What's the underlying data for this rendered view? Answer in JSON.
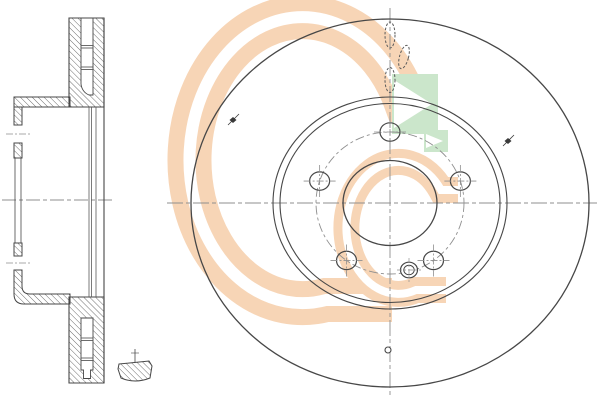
{
  "meta": {
    "description": "Engineering drawing of a ventilated brake disc: left cross-section view, right front view, small edge-detail section, manufacturer G-logo watermark",
    "background": "#ffffff"
  },
  "colors": {
    "line": "#474747",
    "centerline": "#8f8f8f",
    "hidden": "#5a5a5a",
    "hatch": "#606060",
    "watermark_peach": "#f7d5b6",
    "watermark_green": "#cbe6cb",
    "marker": "#3a3a3a"
  },
  "views": {
    "section_view": {
      "name": "cross-section-of-vented-disc",
      "vane_divider_pairs_top": [
        [
          45.5,
          48
        ],
        [
          67,
          69.5
        ]
      ],
      "vane_divider_pairs_bottom": [
        [
          338,
          340.5
        ],
        [
          358,
          360.5
        ]
      ],
      "bolt_hole_tick_y": [
        134,
        263
      ],
      "axis_y": 200
    },
    "front_view": {
      "name": "front-view-of-disc",
      "center": {
        "x": 390,
        "y": 203
      },
      "centerline_v": {
        "x": 390,
        "y1": 8,
        "y2": 397
      },
      "centerline_h": {
        "y": 203,
        "x1": 167,
        "x2": 597
      },
      "circles": [
        {
          "name": "outer-diameter",
          "rx": 199,
          "ry": 184,
          "style": "solid",
          "w": 1.3
        },
        {
          "name": "friction-band-inner-outer-line",
          "rx": 117,
          "ry": 106,
          "style": "solid",
          "w": 1.1
        },
        {
          "name": "friction-band-inner-inner-line",
          "rx": 110,
          "ry": 99.5,
          "style": "solid",
          "w": 1.1
        },
        {
          "name": "bolt-circle",
          "rx": 74,
          "ry": 71,
          "style": "dash-dot",
          "w": 0.9
        },
        {
          "name": "center-bore",
          "rx": 47,
          "ry": 42.5,
          "style": "solid",
          "w": 1.3
        }
      ],
      "bolt_holes": {
        "count": 5,
        "angles_deg": [
          -90,
          -18,
          54,
          126,
          198
        ],
        "circle_rx": 74,
        "circle_ry": 71,
        "rx": 10,
        "ry": 9.2,
        "cross_len": 16
      },
      "pin_hole": {
        "x": 409,
        "y": 270,
        "r_outer": 8.5,
        "r_inner": 5.2
      },
      "small_hole": {
        "x": 388,
        "y": 350,
        "r": 3
      },
      "vent_slots_hidden": [
        {
          "x": 390,
          "y": 35,
          "rx": 5,
          "ry": 13,
          "rot": 0
        },
        {
          "x": 404,
          "y": 57,
          "rx": 4.5,
          "ry": 12,
          "rot": 15
        },
        {
          "x": 390,
          "y": 80,
          "rx": 5,
          "ry": 12.5,
          "rot": 0
        }
      ],
      "surface_markers": [
        {
          "x": 233,
          "y": 120
        },
        {
          "x": 508,
          "y": 141
        }
      ]
    },
    "detail_view": {
      "name": "edge-detail-section",
      "centerline": {
        "x": 135,
        "y1": 349,
        "y2": 362
      }
    }
  },
  "watermark": {
    "name": "manufacturer-logo-G",
    "elements": [
      "outer-g-band",
      "inner-g-band",
      "green-arrow-square",
      "small-green-arrow"
    ]
  }
}
